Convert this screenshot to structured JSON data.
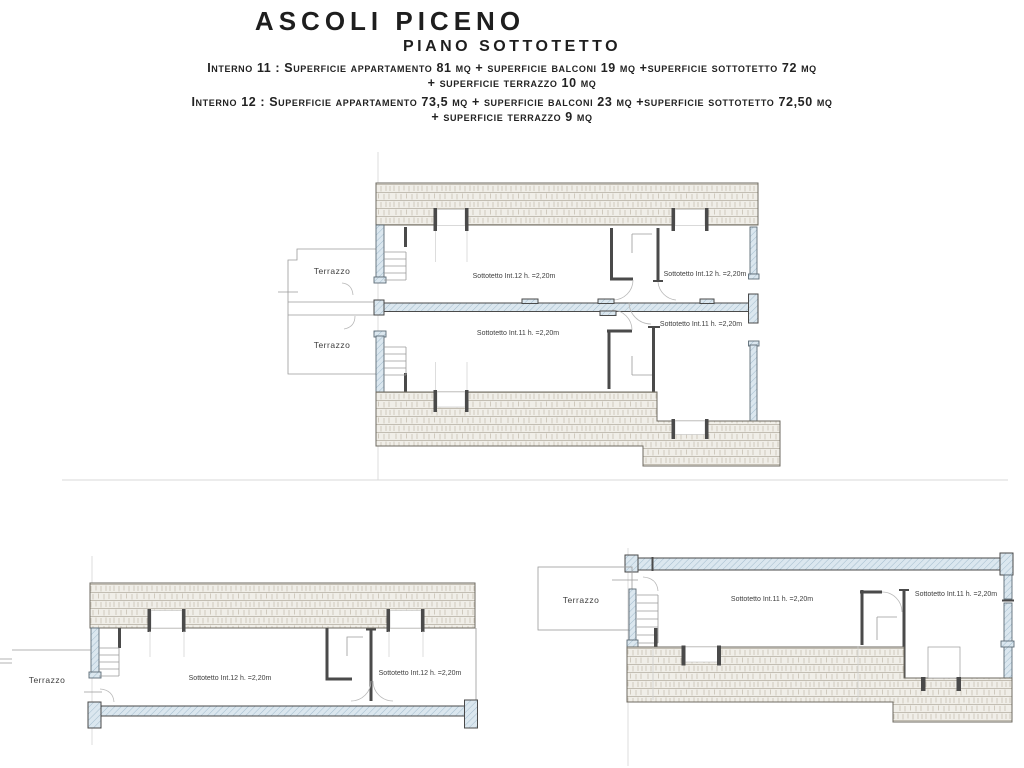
{
  "header": {
    "title": "ASCOLI PICENO",
    "subtitle": "PIANO SOTTOTETTO",
    "interno11_line1": "Interno 11 : Superficie  appartamento 81 mq + superficie  balconi 19 mq +superficie sottotetto 72 mq",
    "interno11_line2": "+ superficie terrazzo 10 mq",
    "interno12_line1": "Interno 12 : Superficie  appartamento 73,5 mq + superficie balconi 23 mq +superficie sottotetto 72,50 mq",
    "interno12_line2": "+ superficie terrazzo 9 mq"
  },
  "colors": {
    "wall_fill_blue": "#dbe7ef",
    "wall_hatch_blue": "#a3bccd",
    "stone_fill": "#f0eee8",
    "stone_line": "#b3ada0",
    "dark_wall": "#4a4a4a",
    "thin_line": "#9a9a9a",
    "text": "#3d3d3d"
  },
  "plans": {
    "main": {
      "terrazzo_upper_label": "Terrazzo",
      "terrazzo_lower_label": "Terrazzo",
      "room_int12_left_label": "Sottotetto Int.12 h. =2,20m",
      "room_int12_right_label": "Sottotetto Int.12 h. =2,20m",
      "room_int11_left_label": "Sottotetto Int.11 h. =2,20m",
      "room_int11_right_label": "Sottotetto Int.11 h. =2,20m"
    },
    "bottom_left": {
      "terrazzo_label": "Terrazzo",
      "room_left_label": "Sottotetto Int.12 h. =2,20m",
      "room_right_label": "Sottotetto Int.12 h. =2,20m"
    },
    "bottom_right": {
      "terrazzo_label": "Terrazzo",
      "room_left_label": "Sottotetto Int.11 h. =2,20m",
      "room_right_label": "Sottotetto Int.11 h. =2,20m"
    }
  }
}
